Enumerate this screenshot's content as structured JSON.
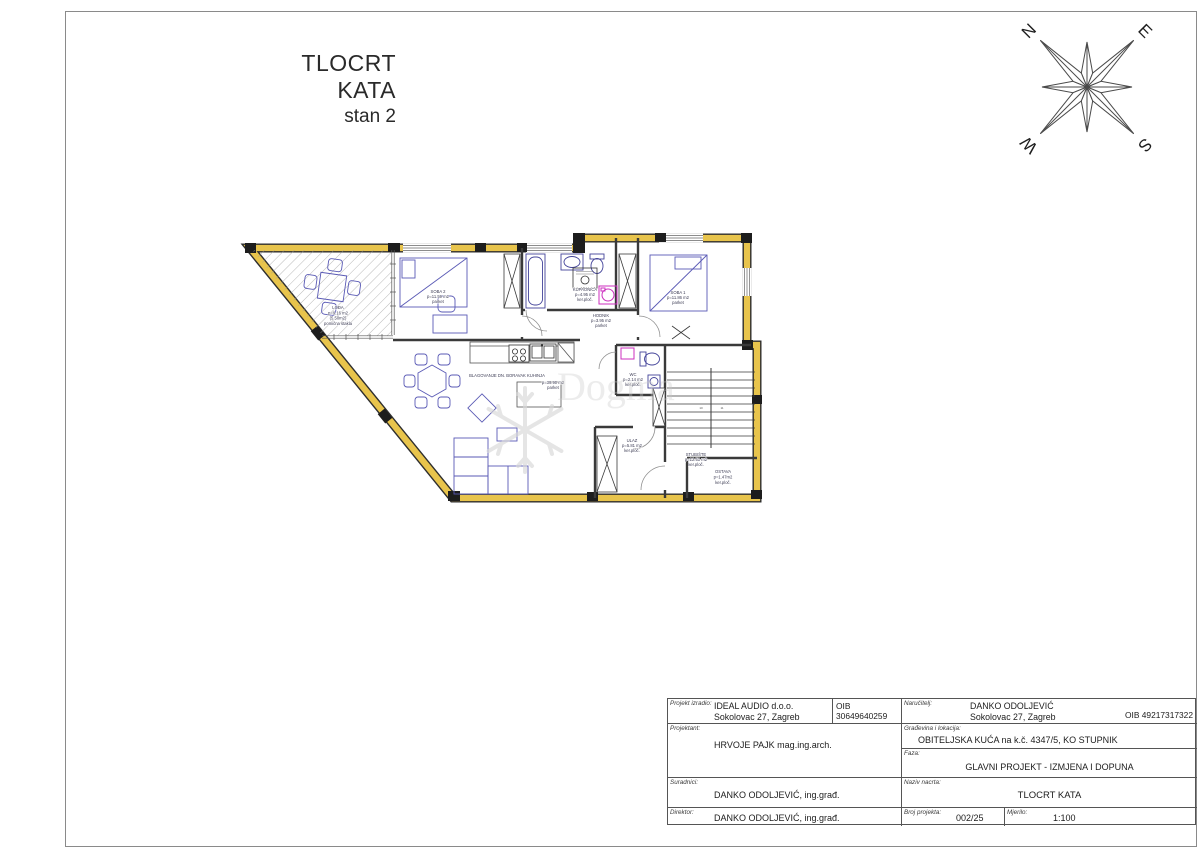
{
  "title": {
    "main": "TLOCRT KATA",
    "sub": "stan 2"
  },
  "compass": {
    "n": "N",
    "e": "E",
    "s": "S",
    "w": "W"
  },
  "watermark": {
    "text": "Dogma"
  },
  "plan": {
    "colors": {
      "wall_accent": "#e8c44c",
      "wall_line": "#2e2e2e",
      "furniture": "#5a5ab5",
      "fixture": "#44449a",
      "appliance_magenta": "#cc2fbf",
      "label": "#3d3d55"
    },
    "stairs": {
      "n1": "10",
      "n2": "11"
    },
    "rooms": [
      {
        "name": "LOĐA",
        "area": "p=9.16 m2",
        "area2": "(5.50m2)",
        "note": "pomična stakla"
      },
      {
        "name": "SOBA 2",
        "area": "p=11.59 m2",
        "floor": "parket"
      },
      {
        "name": "KUPAONICA",
        "area": "p=4.95 m2",
        "floor": "ker.ploč."
      },
      {
        "name": "HODNIK",
        "area": "p=3.95 m2",
        "floor": "parket"
      },
      {
        "name": "SOBA 1",
        "area": "p=11.86 m2",
        "floor": "parket"
      },
      {
        "name": "WC",
        "area": "p=2.14 m2",
        "floor": "ker.ploč."
      },
      {
        "name": "BLAGOVANJE DN. BORAVAK KUHINJA",
        "area": "p=39.90 m2",
        "floor": "parket"
      },
      {
        "name": "ULAZ",
        "area": "p=5.81 m2",
        "floor": "ker.ploč."
      },
      {
        "name": "STUBIŠTE",
        "area": "p=12.51 m2",
        "floor": "ker.ploč."
      },
      {
        "name": "OSTAVA",
        "area": "p=1.47m2",
        "floor": "ker.ploč."
      }
    ]
  },
  "title_block": {
    "projekt_izradio": {
      "label": "Projekt izradio:",
      "line1": "IDEAL AUDIO d.o.o.",
      "line2": "Sokolovac 27, Zagreb",
      "oib": "OIB 30649640259"
    },
    "narucitelj": {
      "label": "Naručitelj:",
      "line1": "DANKO ODOLJEVIĆ",
      "line2": "Sokolovac 27, Zagreb",
      "oib": "OIB 49217317322"
    },
    "projektant": {
      "label": "Projektant:",
      "value": "HRVOJE PAJK mag.ing.arch."
    },
    "gradevina": {
      "label": "Građevina i lokacija:",
      "value": "OBITELJSKA KUĆA na k.č. 4347/5, KO STUPNIK"
    },
    "faza": {
      "label": "Faza:",
      "value": "GLAVNI PROJEKT - IZMJENA I DOPUNA"
    },
    "suradnici": {
      "label": "Suradnici:",
      "value": "DANKO ODOLJEVIĆ, ing.građ."
    },
    "naziv": {
      "label": "Naziv nacrta:",
      "value": "TLOCRT KATA"
    },
    "direktor": {
      "label": "Direktor:",
      "value": "DANKO ODOLJEVIĆ, ing.građ."
    },
    "broj": {
      "label": "Broj projekta:",
      "value": "002/25"
    },
    "mjerilo": {
      "label": "Mjerilo:",
      "value": "1:100"
    }
  }
}
